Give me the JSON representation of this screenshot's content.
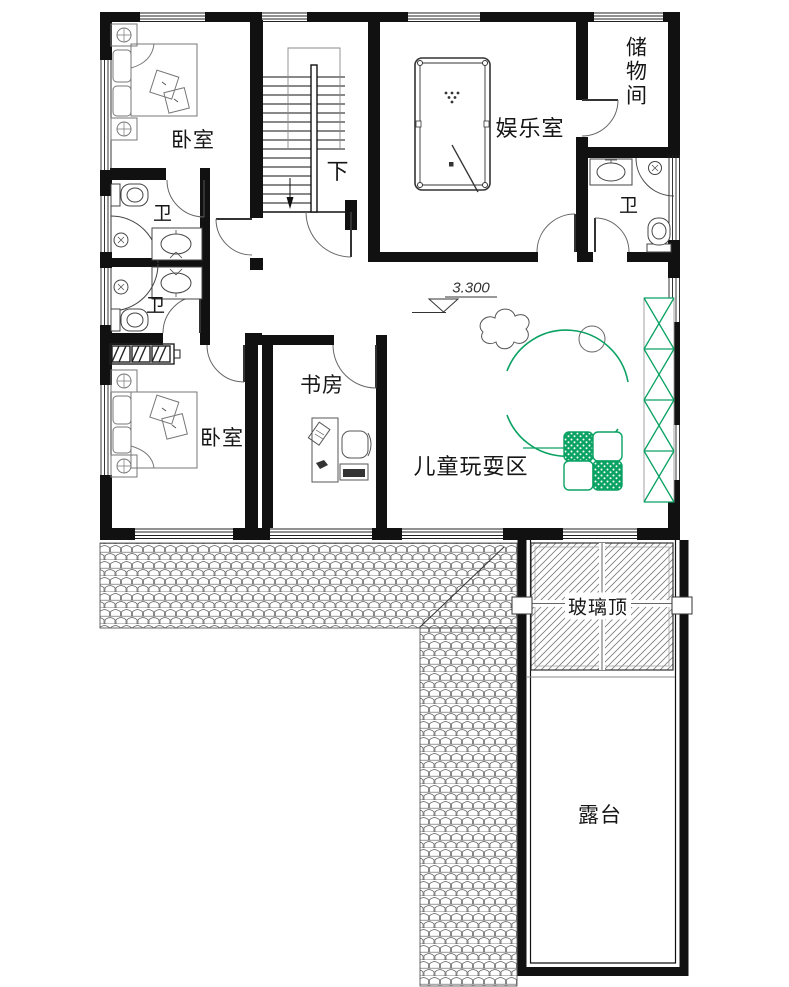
{
  "drawing": {
    "type": "residential-floor-plan",
    "floor_note": "second floor plan with terrace"
  },
  "labels": {
    "bedroom_top": "卧室",
    "bedroom_bottom": "卧室",
    "entertainment": "娱乐室",
    "storage": "储物间",
    "bath_left_top": "卫",
    "bath_left_bottom": "卫",
    "bath_right": "卫",
    "study": "书房",
    "play_area": "儿童玩耍区",
    "glass_roof": "玻璃顶",
    "terrace": "露台",
    "stairs_down": "下",
    "elevation": "3.300"
  },
  "colors": {
    "wall": "#111111",
    "fixture_line": "#444444",
    "tile_line": "#555555",
    "glass_hatch": "#777777",
    "green": "#0aa263"
  },
  "icons": {
    "stairs_arrow": "down-arrow",
    "elevation_marker": "level-triangle",
    "bed_lamp": "crossed-circle"
  }
}
